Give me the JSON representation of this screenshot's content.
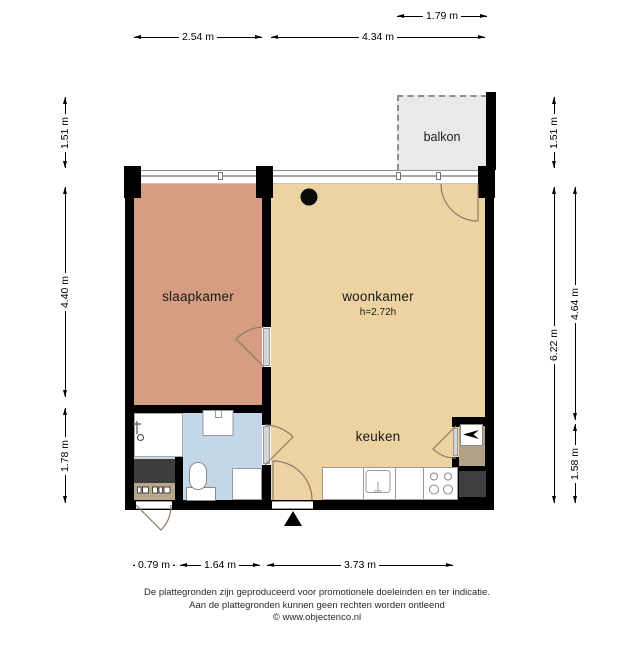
{
  "floorplan": {
    "rooms": {
      "balkon": {
        "label": "balkon"
      },
      "slaapkamer": {
        "label": "slaapkamer"
      },
      "woonkamer": {
        "label": "woonkamer",
        "ceiling_height": "h=2.72h"
      },
      "keuken": {
        "label": "keuken"
      }
    },
    "colors": {
      "wall": "#000000",
      "slaapkamer_floor": "#d69d82",
      "woonkamer_floor": "#eed3a2",
      "badkamer_floor": "#c3d7e9",
      "balkon_floor": "#e9e9e9",
      "closet_dark": "#3d3d3d",
      "meterkast_floor": "#b7a88d",
      "alcove_floor": "#b1a187",
      "door_arc": "#8b7b6a"
    }
  },
  "dimensions": {
    "top": [
      {
        "label": "1.79 m"
      },
      {
        "label": "2.54 m"
      },
      {
        "label": "4.34 m"
      }
    ],
    "left": [
      {
        "label": "1.51 m"
      },
      {
        "label": "4.40 m"
      },
      {
        "label": "1.78 m"
      }
    ],
    "right": [
      {
        "label": "1.51 m"
      },
      {
        "label": "6.22 m"
      },
      {
        "label": "4.64 m"
      },
      {
        "label": "1.58 m"
      }
    ],
    "bottom": [
      {
        "label": "0.79 m"
      },
      {
        "label": "1.64 m"
      },
      {
        "label": "3.73 m"
      }
    ]
  },
  "footer": {
    "line1": "De plattegronden zijn geproduceerd voor promotionele doeleinden en ter indicatie.",
    "line2": "Aan de plattegronden kunnen geen rechten worden ontleend",
    "line3": "© www.objectenco.nl"
  }
}
